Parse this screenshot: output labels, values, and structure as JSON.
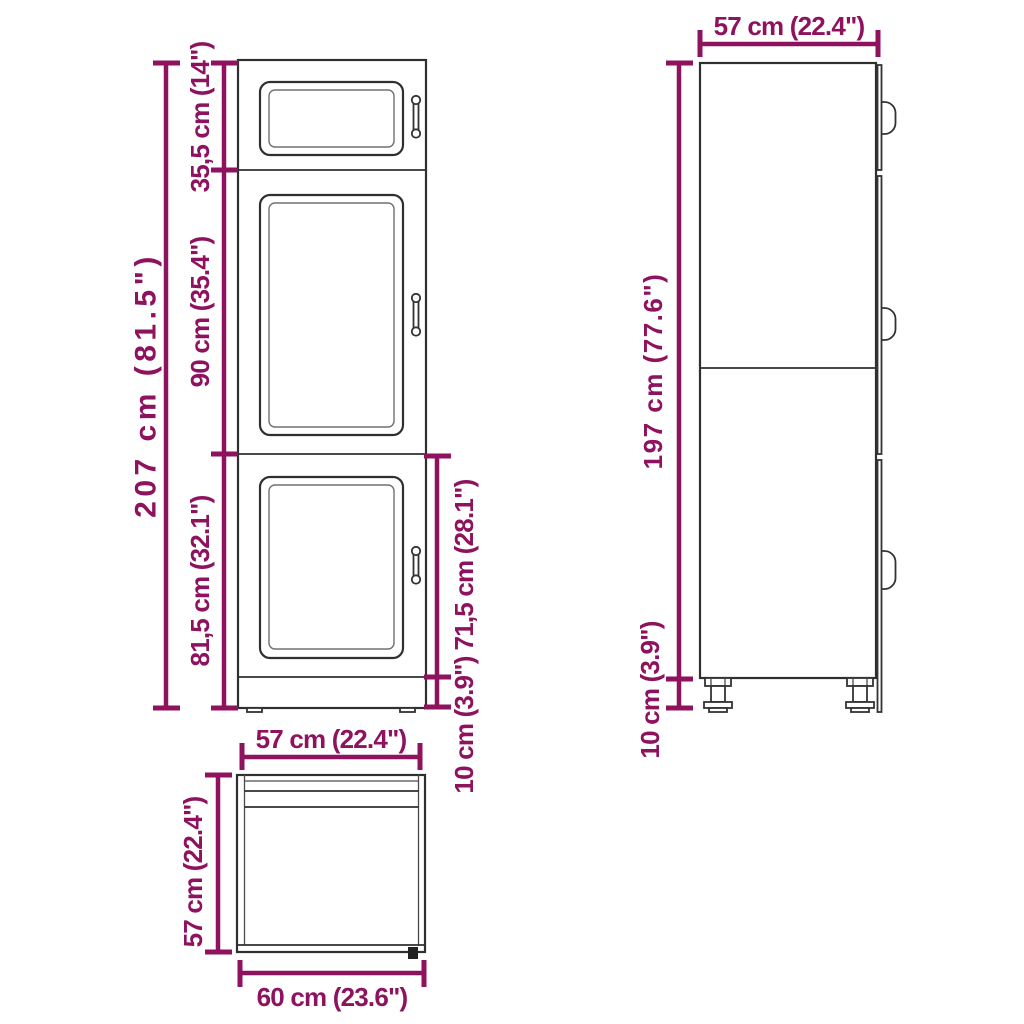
{
  "colors": {
    "dimension_accent": "#8E125E",
    "outline": "#2f2f2f"
  },
  "front_view": {
    "total_height": "207 cm (81.5\")",
    "upper_section_height": "35,5 cm (14\")",
    "middle_section_height": "90 cm (35.4\")",
    "lower_section_height": "81,5 cm (32.1\")",
    "lower_door_height": "71,5 cm (28.1\")",
    "plinth_height": "10 cm (3.9\")"
  },
  "side_view": {
    "depth": "57 cm (22.4\")",
    "body_height": "197 cm (77.6\")",
    "leg_height": "10 cm (3.9\")"
  },
  "top_view": {
    "width": "57 cm (22.4\")",
    "side_depth": "57 cm (22.4\")",
    "total_depth": "60 cm (23.6\")"
  }
}
